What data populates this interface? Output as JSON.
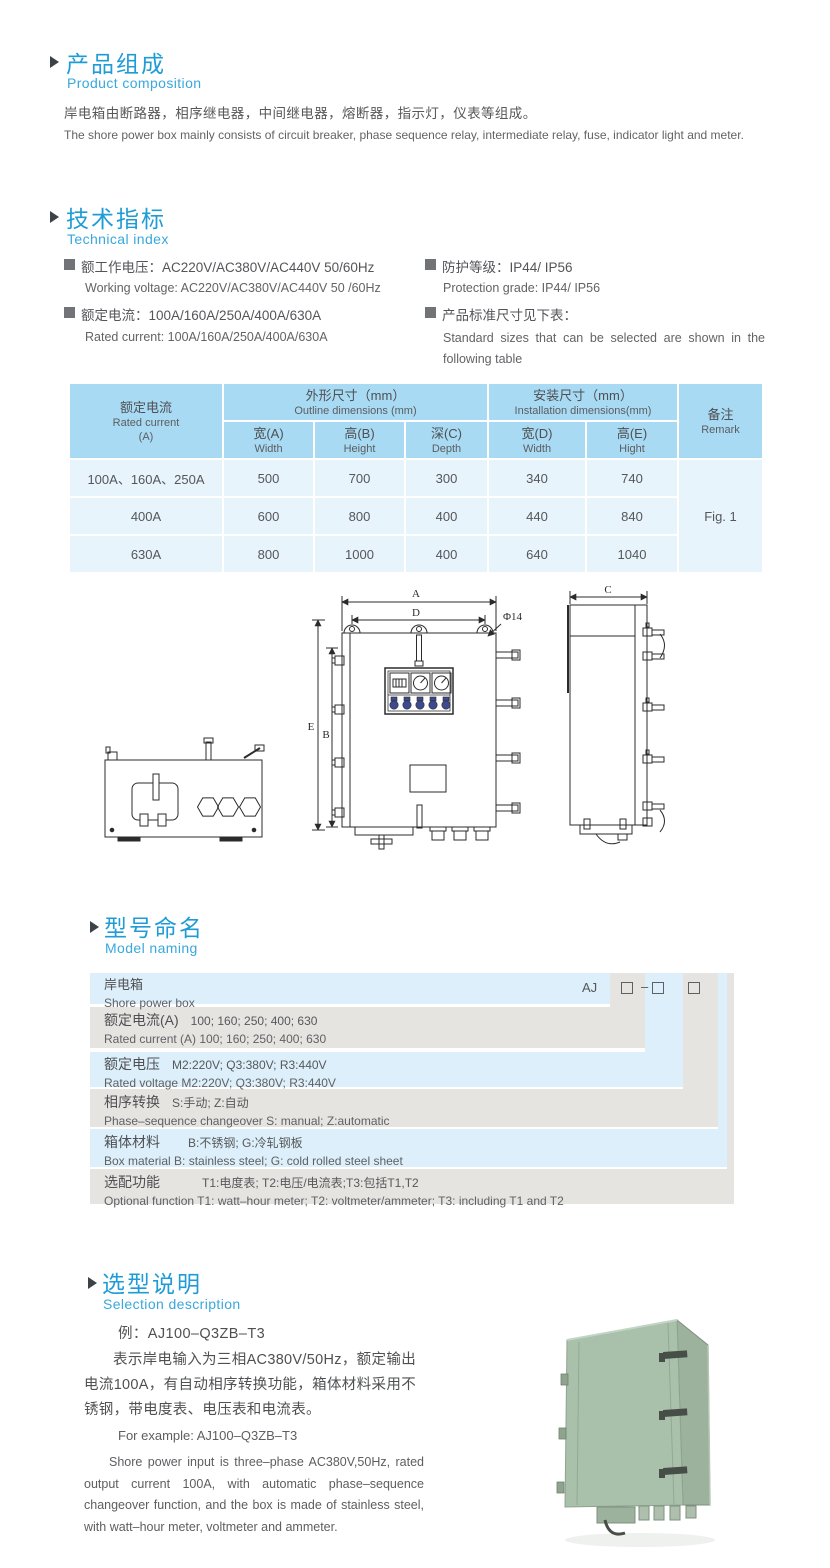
{
  "colors": {
    "accent_blue": "#1f9cd6",
    "sub_blue": "#38a8dc",
    "text_gray": "#57585a",
    "table_header_bg": "#a8daf3",
    "table_body_bg": "#e7f4fb",
    "naming_blue": "#dceffa",
    "naming_gray": "#e5e4e1",
    "photo_green": "#a9c0ab"
  },
  "composition": {
    "title_cn": "产品组成",
    "title_en": "Product  composition",
    "body_cn": "岸电箱由断路器，相序继电器，中间继电器，熔断器，指示灯，仪表等组成。",
    "body_en": "The shore power box mainly consists of circuit breaker, phase sequence relay, intermediate relay, fuse, indicator light and meter."
  },
  "technical": {
    "title_cn": "技术指标",
    "title_en": "Technical index",
    "specs": [
      {
        "cn": "额工作电压：AC220V/AC380V/AC440V  50/60Hz",
        "en": "Working voltage: AC220V/AC380V/AC440V 50 /60Hz"
      },
      {
        "cn": "额定电流：100A/160A/250A/400A/630A",
        "en": "Rated current: 100A/160A/250A/400A/630A"
      },
      {
        "cn": "防护等级：IP44/ IP56",
        "en": "Protection grade: IP44/ IP56"
      },
      {
        "cn": "产品标准尺寸见下表：",
        "en": "Standard sizes that can be selected are shown in the following table"
      }
    ]
  },
  "size_table": {
    "col_current": {
      "cn": "额定电流",
      "en": "Rated current",
      "unit": "(A)"
    },
    "group_outline": {
      "cn": "外形尺寸（mm）",
      "en": "Outline dimensions (mm)"
    },
    "group_install": {
      "cn": "安装尺寸（mm）",
      "en": "Installation dimensions(mm)"
    },
    "col_remark": {
      "cn": "备注",
      "en": "Remark"
    },
    "sub_headers": [
      {
        "cn": "宽(A)",
        "en": "Width"
      },
      {
        "cn": "高(B)",
        "en": "Height"
      },
      {
        "cn": "深(C)",
        "en": "Depth"
      },
      {
        "cn": "宽(D)",
        "en": "Width"
      },
      {
        "cn": "高(E)",
        "en": "Hight"
      }
    ],
    "rows": [
      {
        "current": "100A、160A、250A",
        "values": [
          "500",
          "700",
          "300",
          "340",
          "740"
        ]
      },
      {
        "current": "400A",
        "values": [
          "600",
          "800",
          "400",
          "440",
          "840"
        ]
      },
      {
        "current": "630A",
        "values": [
          "800",
          "1000",
          "400",
          "640",
          "1040"
        ]
      }
    ],
    "remark": "Fig. 1"
  },
  "drawing": {
    "labels": {
      "a": "A",
      "d": "D",
      "hole": "Φ14",
      "e": "E",
      "b": "B",
      "c": "C"
    }
  },
  "naming": {
    "title_cn": "型号命名",
    "title_en": "Model naming",
    "code_prefix": "AJ",
    "code_dash": "–",
    "rows": [
      {
        "cn_label": "岸电箱",
        "cn_value": "",
        "en": "Shore power box"
      },
      {
        "cn_label": "额定电流(A)",
        "cn_value": "100; 160; 250; 400; 630",
        "en": "Rated current (A) 100; 160; 250; 400; 630"
      },
      {
        "cn_label": "额定电压",
        "cn_value": "M2:220V;  Q3:380V;  R3:440V",
        "en": "Rated voltage  M2:220V;  Q3:380V;  R3:440V"
      },
      {
        "cn_label": "相序转换",
        "cn_value": "S:手动; Z:自动",
        "en": "Phase–sequence changeover  S: manual;  Z:automatic"
      },
      {
        "cn_label": "箱体材料",
        "cn_value": "B:不锈钢;  G:冷轧钢板",
        "en": "Box material   B: stainless steel; G: cold rolled steel sheet"
      },
      {
        "cn_label": "选配功能",
        "cn_value": "T1:电度表;  T2:电压/电流表;T3:包括T1,T2",
        "en": "Optional function  T1: watt–hour meter; T2: voltmeter/ammeter; T3: including T1 and T2"
      }
    ]
  },
  "selection": {
    "title_cn": "选型说明",
    "title_en": "Selection description",
    "example_cn": "例：AJ100–Q3ZB–T3",
    "body_cn": "表示岸电输入为三相AC380V/50Hz，额定输出电流100A，有自动相序转换功能，箱体材料采用不锈钢，带电度表、电压表和电流表。",
    "example_en": "For example: AJ100–Q3ZB–T3",
    "body_en": "Shore power input is three–phase AC380V,50Hz, rated output current 100A, with automatic phase–sequence changeover function, and the box is made of stainless steel, with watt–hour meter, voltmeter and ammeter."
  }
}
